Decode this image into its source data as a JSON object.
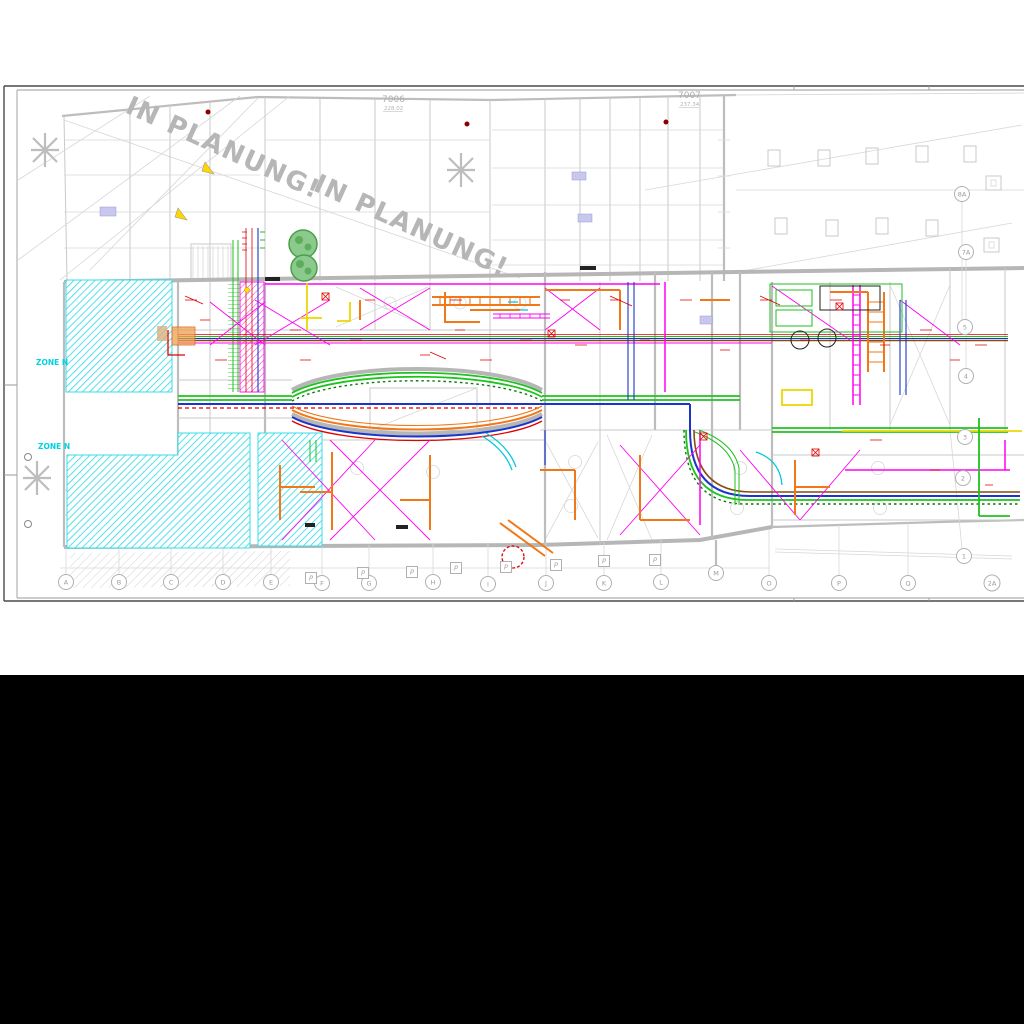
{
  "sheet": {
    "watermark_1": "IN PLANUNG!",
    "watermark_2": "IN PLANUNG!",
    "refs": {
      "left_number": "7006",
      "left_elev": "228.02",
      "right_number": "7007",
      "right_elev": "237.34"
    },
    "zone_label_1": "ZONE N",
    "zone_label_2": "ZONE N"
  },
  "grid": {
    "bottom": [
      "A",
      "B",
      "C",
      "D",
      "E",
      "F",
      "G",
      "H",
      "I",
      "J",
      "K",
      "L",
      "M",
      "O",
      "P",
      "Q",
      "2A"
    ],
    "right": [
      "8A",
      "7A",
      "5",
      "4",
      "3",
      "2",
      "1"
    ],
    "parking_label": "P"
  },
  "colors": {
    "zone_hatch": "#35dce8",
    "duct_green": "#1ec21e",
    "pipe_blue": "#1a35cc",
    "pipe_red": "#e00000",
    "pipe_magenta": "#ff00f0",
    "duct_orange": "#f07818",
    "pipe_yellow": "#ecd800",
    "plan_gray": "#c4c4c4",
    "watermark_gray": "#b6b6b6",
    "letterbox": "#000000"
  }
}
